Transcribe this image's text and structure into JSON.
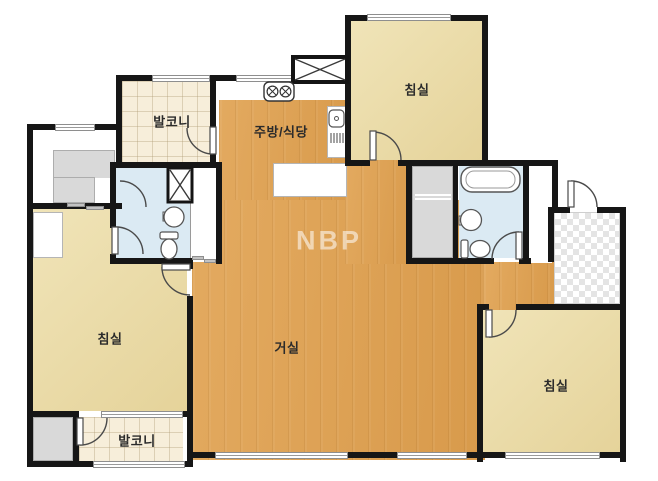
{
  "floorplan": {
    "watermark": "NBP",
    "labels": {
      "balcony_top": "발코니",
      "kitchen_dining": "주방/식당",
      "bedroom_top_right": "침실",
      "bedroom_left": "침실",
      "living_room": "거실",
      "bedroom_bottom_right": "침실",
      "balcony_bottom": "발코니"
    },
    "colors": {
      "wall": "#161616",
      "wood_floor": "#dda45c",
      "bedroom_floor": "#ead9a5",
      "balcony_tile": "#f7eeda",
      "bathroom_floor": "#dbeaf3",
      "closet_gray": "#d9d9d9",
      "entry_checker": "#e4e4e4"
    }
  }
}
